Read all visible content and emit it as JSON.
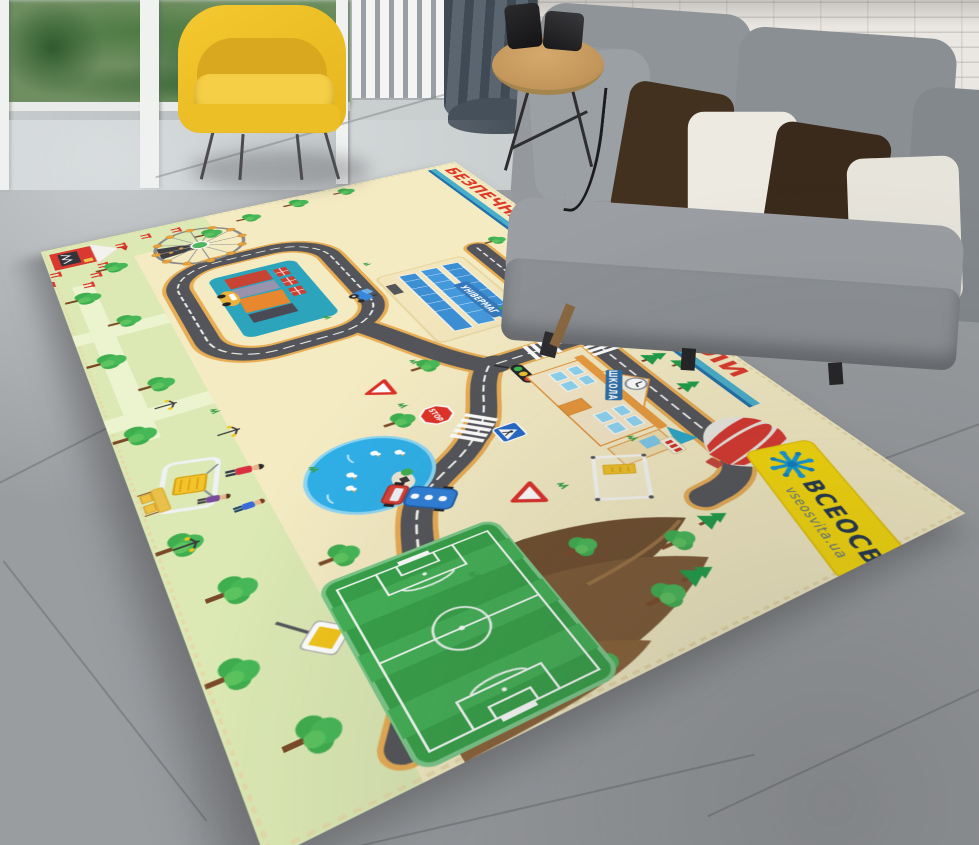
{
  "rug": {
    "edge_text": "БЕЗПЕЧНА ДОРОГА ДО ШКОЛИ",
    "store_sign": "УНІВЕРМАГ",
    "school_sign": "ШКОЛА",
    "stop_sign": "STOP",
    "brand": {
      "title": "ВСЕОСВІТА",
      "subtitle": "vseosvita.ua"
    },
    "colors": {
      "base": "#f4ebc3",
      "park": "#dce9b4",
      "road": "#54555a",
      "road_edge": "#e9ad54",
      "water": "#2fb0e8",
      "field_green": "#3aa24c",
      "banner_yellow": "#f7d90a",
      "banner_text": "#22364e",
      "logo_blue": "#149ad6",
      "balloon_red": "#d8372e",
      "station_teal": "#2ba4bc",
      "hill_brown": "#7d5a36",
      "sign_red": "#e03228",
      "edge_text_red": "#dd3a28"
    }
  },
  "room": {
    "colors": {
      "floor_gray": "#9a9da0",
      "brick_wall": "#eae7e2",
      "sofa_gray": "#8d9296",
      "pillow_brown": "#43311f",
      "pillow_white": "#edeae2",
      "armchair_yellow": "#eec12d",
      "curtain_slate": "#49525c",
      "table_wood": "#c89a5e",
      "greenery_green": "#4c7a42"
    }
  }
}
